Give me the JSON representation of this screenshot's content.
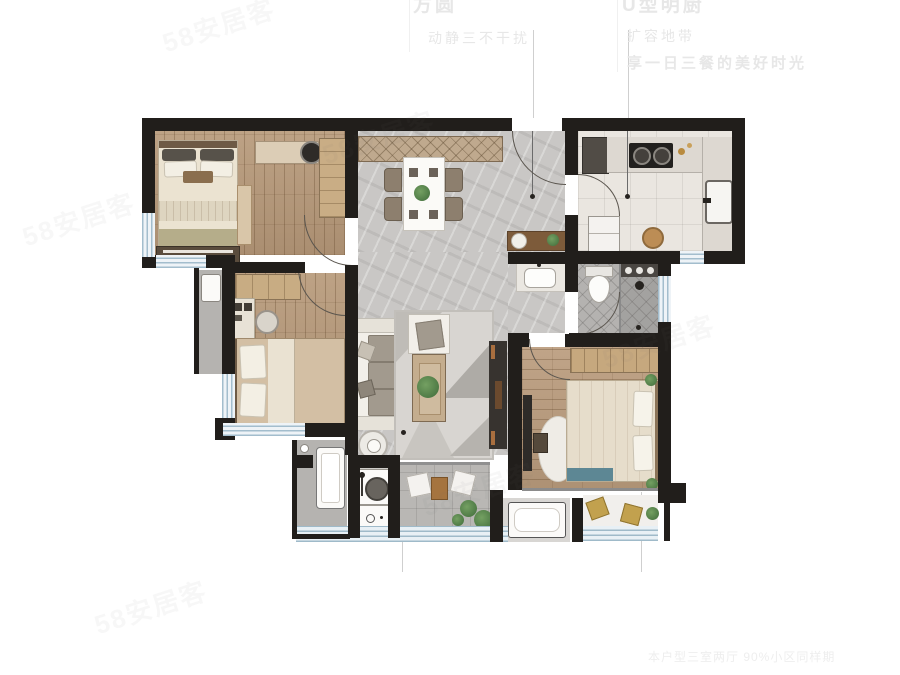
{
  "marketing": {
    "col1_line1": "方圆",
    "col1_line2": "动静三不干扰",
    "col2_line1": "U型明厨",
    "col2_line2": "扩容地带",
    "col2_line3": "享一日三餐的美好时光",
    "footer": "本户型三室两厅 90%小区同样期"
  },
  "watermark": {
    "text": "58安居客"
  },
  "colors": {
    "wall": "#211e1b",
    "wood": "#b3977a",
    "tile_gray": "#c9c7c5",
    "kitchen_floor": "#eae6e0",
    "bath_floor": "#b4b2b0",
    "balcony_floor": "#b9b7b4",
    "window_blue": "#a3bdcd",
    "plant_green": "#4e7b49",
    "teal_accent": "#5d8794",
    "cabinet_tan": "#c6a87e",
    "dark_furniture": "#37332f",
    "faint_text": "#e7e7e7"
  },
  "rooms": [
    {
      "id": "bedroom-top-left",
      "furniture": [
        "double-bed",
        "desk",
        "desk-chair",
        "wardrobe",
        "dresser",
        "nightstand"
      ]
    },
    {
      "id": "dining-area",
      "furniture": [
        "sideboard",
        "dining-table",
        "dining-chairs",
        "plant"
      ]
    },
    {
      "id": "entry-hall",
      "furniture": [
        "console-table",
        "lamp",
        "plant",
        "pendant-light"
      ]
    },
    {
      "id": "kitchen",
      "furniture": [
        "tall-cabinet",
        "gas-stove",
        "sink",
        "fridge",
        "round-mat"
      ]
    },
    {
      "id": "bathroom",
      "furniture": [
        "toilet",
        "shower",
        "glass-partition",
        "vanity-basin"
      ]
    },
    {
      "id": "bedroom-middle-left",
      "furniture": [
        "bed",
        "desk",
        "chair",
        "shelf"
      ]
    },
    {
      "id": "living-room",
      "furniture": [
        "sofa",
        "armchair",
        "coffee-table",
        "rug",
        "tv-console",
        "side-table"
      ]
    },
    {
      "id": "master-bedroom",
      "furniture": [
        "double-bed",
        "wardrobe",
        "tv",
        "nightstand-plants",
        "round-rug",
        "bench"
      ]
    },
    {
      "id": "laundry-bath",
      "furniture": [
        "washing-machine",
        "cabinet",
        "shower-fixture"
      ]
    },
    {
      "id": "living-balcony",
      "furniture": [
        "lounge-cushions",
        "small-table",
        "plants"
      ]
    },
    {
      "id": "master-balcony",
      "furniture": [
        "cushions",
        "plant",
        "ac-platform"
      ]
    },
    {
      "id": "ac-ledge",
      "furniture": [
        "ac-unit"
      ]
    }
  ]
}
